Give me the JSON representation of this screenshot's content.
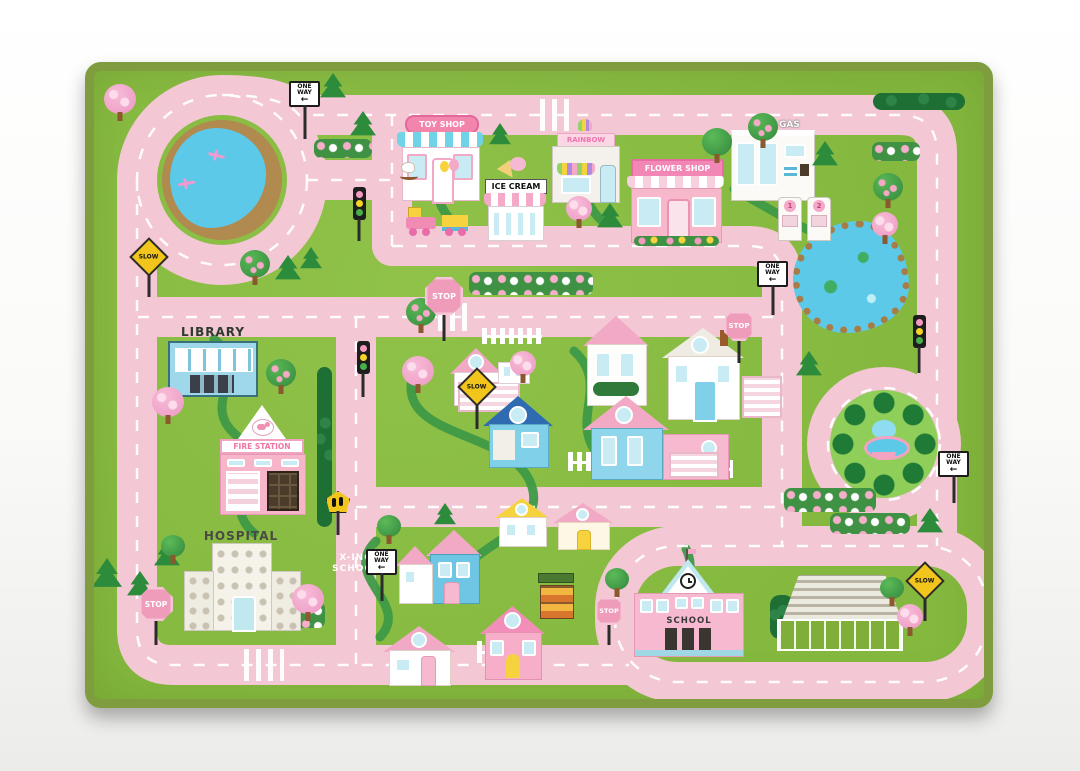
{
  "rug": {
    "shops": {
      "toy_shop": "TOY SHOP",
      "ice_cream": "ICE CREAM",
      "rainbow": "RAINBOW",
      "flower_shop": "FLOWER SHOP",
      "gas": "GAS"
    },
    "buildings": {
      "library": "LIBRARY",
      "fire_station": "FIRE STATION",
      "hospital": "HOSPITAL",
      "school": "SCHOOL"
    },
    "signs": {
      "stop": "STOP",
      "slow": "SLOW",
      "one_way": "ONE WAY"
    },
    "road_markings": {
      "school_crossing_line1": "X-ING",
      "school_crossing_line2": "SCHOOL"
    },
    "gas_pumps": {
      "pump1": "1",
      "pump2": "2"
    },
    "icons": {
      "one_way_arrow": "←"
    },
    "colors": {
      "grass": "#8abc44",
      "road_pink": "#f3c7d3",
      "rug_border_olive": "#7f9c3e",
      "water_blue": "#5cc9e9",
      "stop_sign_pink": "#ef9cba",
      "slow_sign_yellow": "#f2c51d"
    }
  }
}
